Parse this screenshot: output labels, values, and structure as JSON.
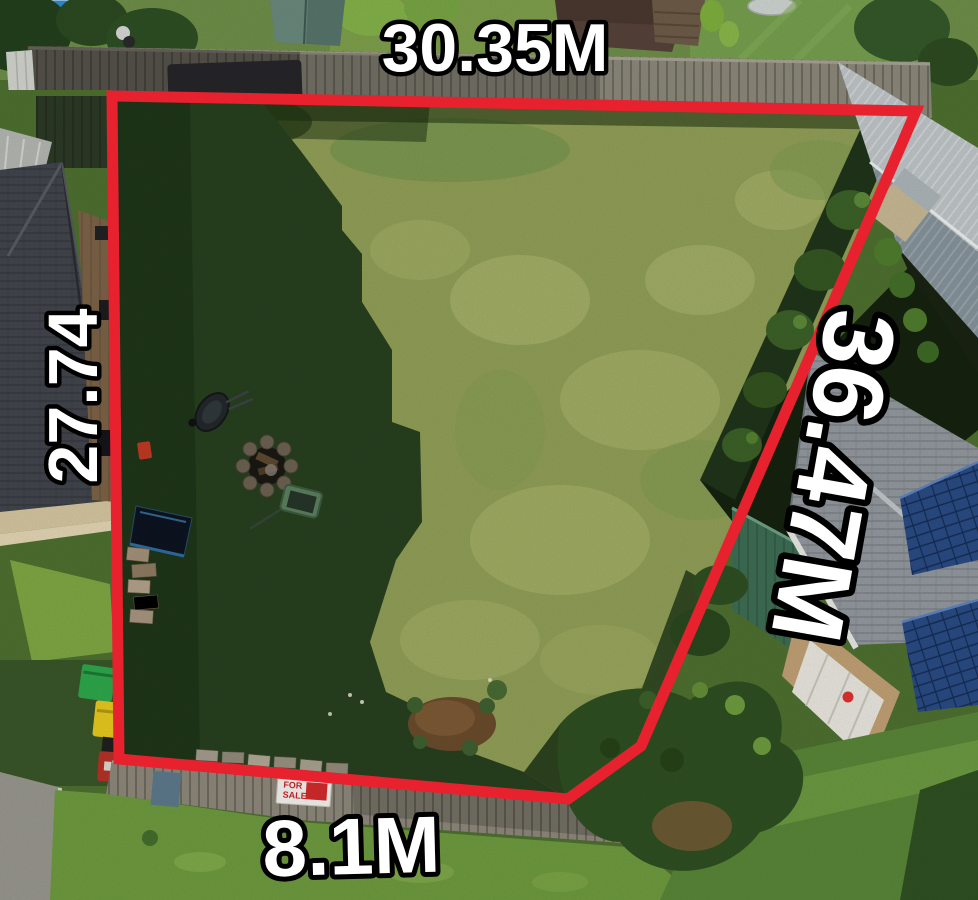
{
  "scene": {
    "title": "Aerial drone photo of a vacant grass land parcel outlined with a red surveyed boundary",
    "boundary_color": "#e8212e",
    "label_color": "#ffffff",
    "label_outline_color": "#000000"
  },
  "dimensions": {
    "top": "30.35M",
    "left": "27.74",
    "right": "36.47M",
    "bottom": "8.1M"
  },
  "sign": {
    "line1": "FOR",
    "line2": "SALE",
    "color": "#c9252b"
  },
  "objects": [
    "swimming-pool",
    "timber-fence",
    "neighbour-house-roof",
    "dark-tile-roof-house",
    "wheelie-bins-green-yellow-red",
    "wheelbarrow",
    "fire-pit",
    "garden-cart",
    "ground-solar-panel",
    "brick-pile",
    "dirt-patch",
    "for-sale-sign",
    "metal-shed",
    "green-shed",
    "solar-roof-house",
    "hedge",
    "retaining-wall"
  ]
}
